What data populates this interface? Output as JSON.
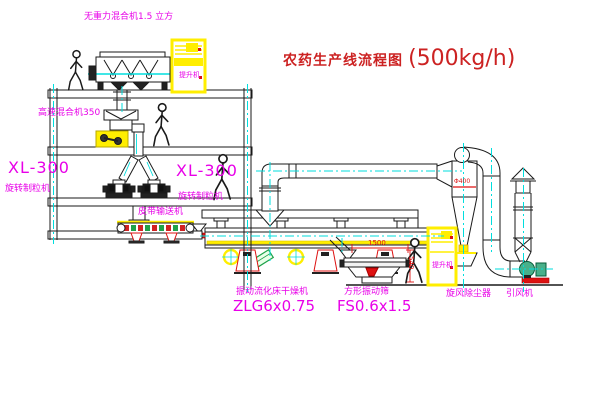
{
  "title": {
    "name_zh": "农药生产线流程图",
    "capacity": "(500kg/h)"
  },
  "labels": {
    "gravity_free_mixer": "无重力混合机1.5 立方",
    "high_speed_mixer": "高速混合机350",
    "granulator_left_model": "XL-300",
    "granulator_left_name": "旋转制粒机",
    "granulator_center_model": "XL-300",
    "granulator_center_name": "旋转制粒机",
    "belt_conveyor": "皮带输送机",
    "fluid_bed_dryer_name": "振动流化床干燥机",
    "fluid_bed_dryer_model": "ZLG6x0.75",
    "vibrating_screen_name": "方形振动筛",
    "vibrating_screen_model": "FS0.6x1.5",
    "cyclone_collector": "旋风除尘器",
    "induced_draft_fan": "引风机",
    "bucket_elevator_top": "提升机",
    "bucket_elevator_right": "提升机"
  },
  "dimensions": {
    "screen_length": "1500",
    "screen_height": "540",
    "cyclone_dia": "Φ400"
  },
  "figures": {
    "person_icon": "worker-silhouette",
    "count": 4
  },
  "colors": {
    "background": "#ffffff",
    "line_black": "#1a1a1a",
    "label_magenta": "#e800e8",
    "title_red": "#cc2222",
    "centerline_cyan": "#00dede",
    "equipment_yellow": "#ffee00",
    "accent_red": "#dd1111",
    "accent_green": "#1fa24a"
  }
}
